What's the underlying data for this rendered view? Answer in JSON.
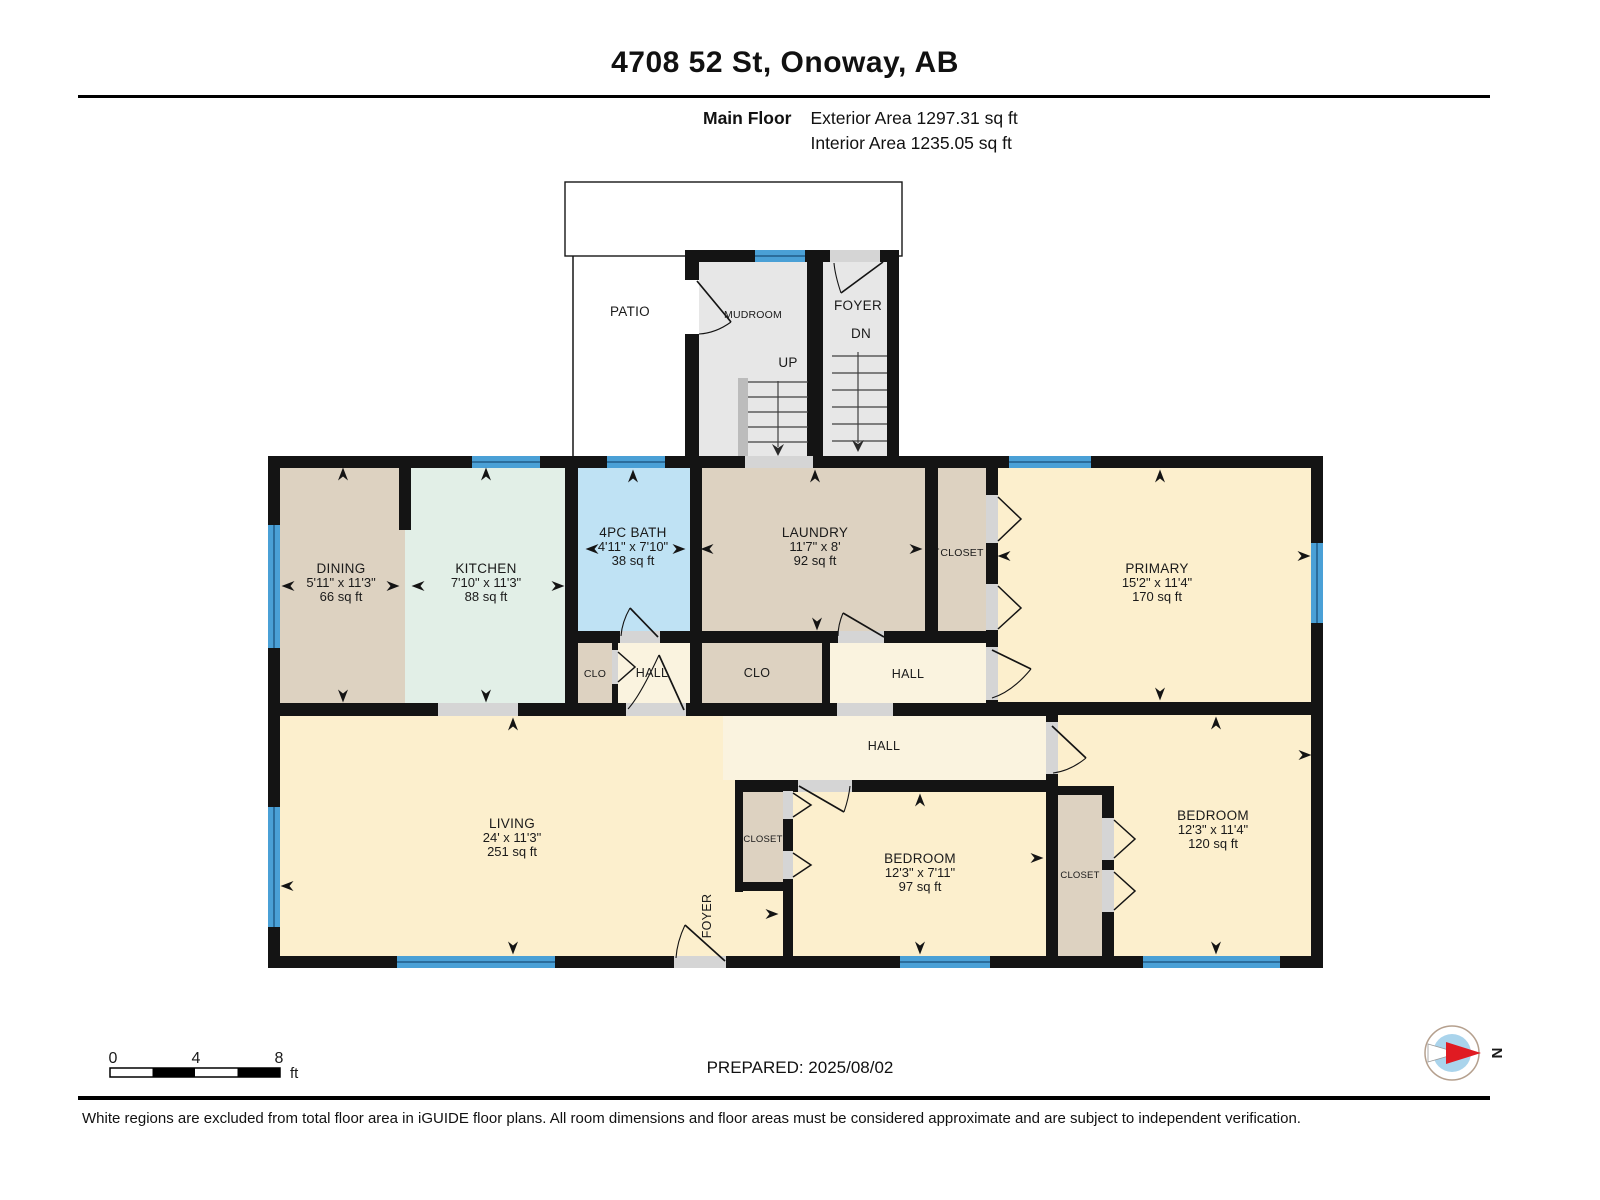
{
  "header": {
    "title": "4708 52 St, Onoway, AB",
    "floor_label": "Main Floor",
    "exterior_area": "Exterior Area 1297.31 sq ft",
    "interior_area": "Interior Area 1235.05 sq ft"
  },
  "rooms": {
    "patio": {
      "name": "PATIO"
    },
    "mudroom": {
      "name": "MUDROOM"
    },
    "foyer_upper": {
      "name": "FOYER",
      "stairs": "DN"
    },
    "stairs_up": {
      "label": "UP"
    },
    "dining": {
      "name": "DINING",
      "dims": "5'11\" x 11'3\"",
      "area": "66 sq ft"
    },
    "kitchen": {
      "name": "KITCHEN",
      "dims": "7'10\" x 11'3\"",
      "area": "88 sq ft"
    },
    "bath": {
      "name": "4PC BATH",
      "dims": "4'11\" x 7'10\"",
      "area": "38 sq ft"
    },
    "laundry": {
      "name": "LAUNDRY",
      "dims": "11'7\" x 8'",
      "area": "92 sq ft"
    },
    "closet_top": {
      "name": "CLOSET"
    },
    "primary": {
      "name": "PRIMARY",
      "dims": "15'2\" x 11'4\"",
      "area": "170 sq ft"
    },
    "clo_1": {
      "name": "CLO"
    },
    "hall_1": {
      "name": "HALL"
    },
    "clo_2": {
      "name": "CLO"
    },
    "hall_2": {
      "name": "HALL"
    },
    "hall_main": {
      "name": "HALL"
    },
    "living": {
      "name": "LIVING",
      "dims": "24' x 11'3\"",
      "area": "251 sq ft"
    },
    "closet_bed1": {
      "name": "CLOSET"
    },
    "bedroom_mid": {
      "name": "BEDROOM",
      "dims": "12'3\" x 7'11\"",
      "area": "97 sq ft"
    },
    "closet_bed2": {
      "name": "CLOSET"
    },
    "bedroom_right": {
      "name": "BEDROOM",
      "dims": "12'3\" x 11'4\"",
      "area": "120 sq ft"
    },
    "foyer_lower": {
      "name": "FOYER"
    }
  },
  "scale_bar": {
    "ticks": [
      "0",
      "4",
      "8"
    ],
    "unit": "ft"
  },
  "compass": {
    "label": "N"
  },
  "footer": {
    "prepared": "PREPARED: 2025/08/02",
    "disclaimer": "White regions are excluded from total floor area in iGUIDE floor plans. All room dimensions and floor areas must be considered approximate and are subject to independent verification."
  },
  "colors": {
    "room_yellow": "#fcefcd",
    "room_tan": "#ddd2c1",
    "room_green": "#e2efe7",
    "room_blue": "#bfe2f4",
    "hall_cream": "#faf3df",
    "gray_room": "#e7e7e7",
    "opening_gray": "#d5d5d5",
    "stair_strip": "#bcbcbc",
    "window_blue": "#4aa0d6",
    "window_dark": "#2b6d9c",
    "wall_black": "#141414"
  }
}
